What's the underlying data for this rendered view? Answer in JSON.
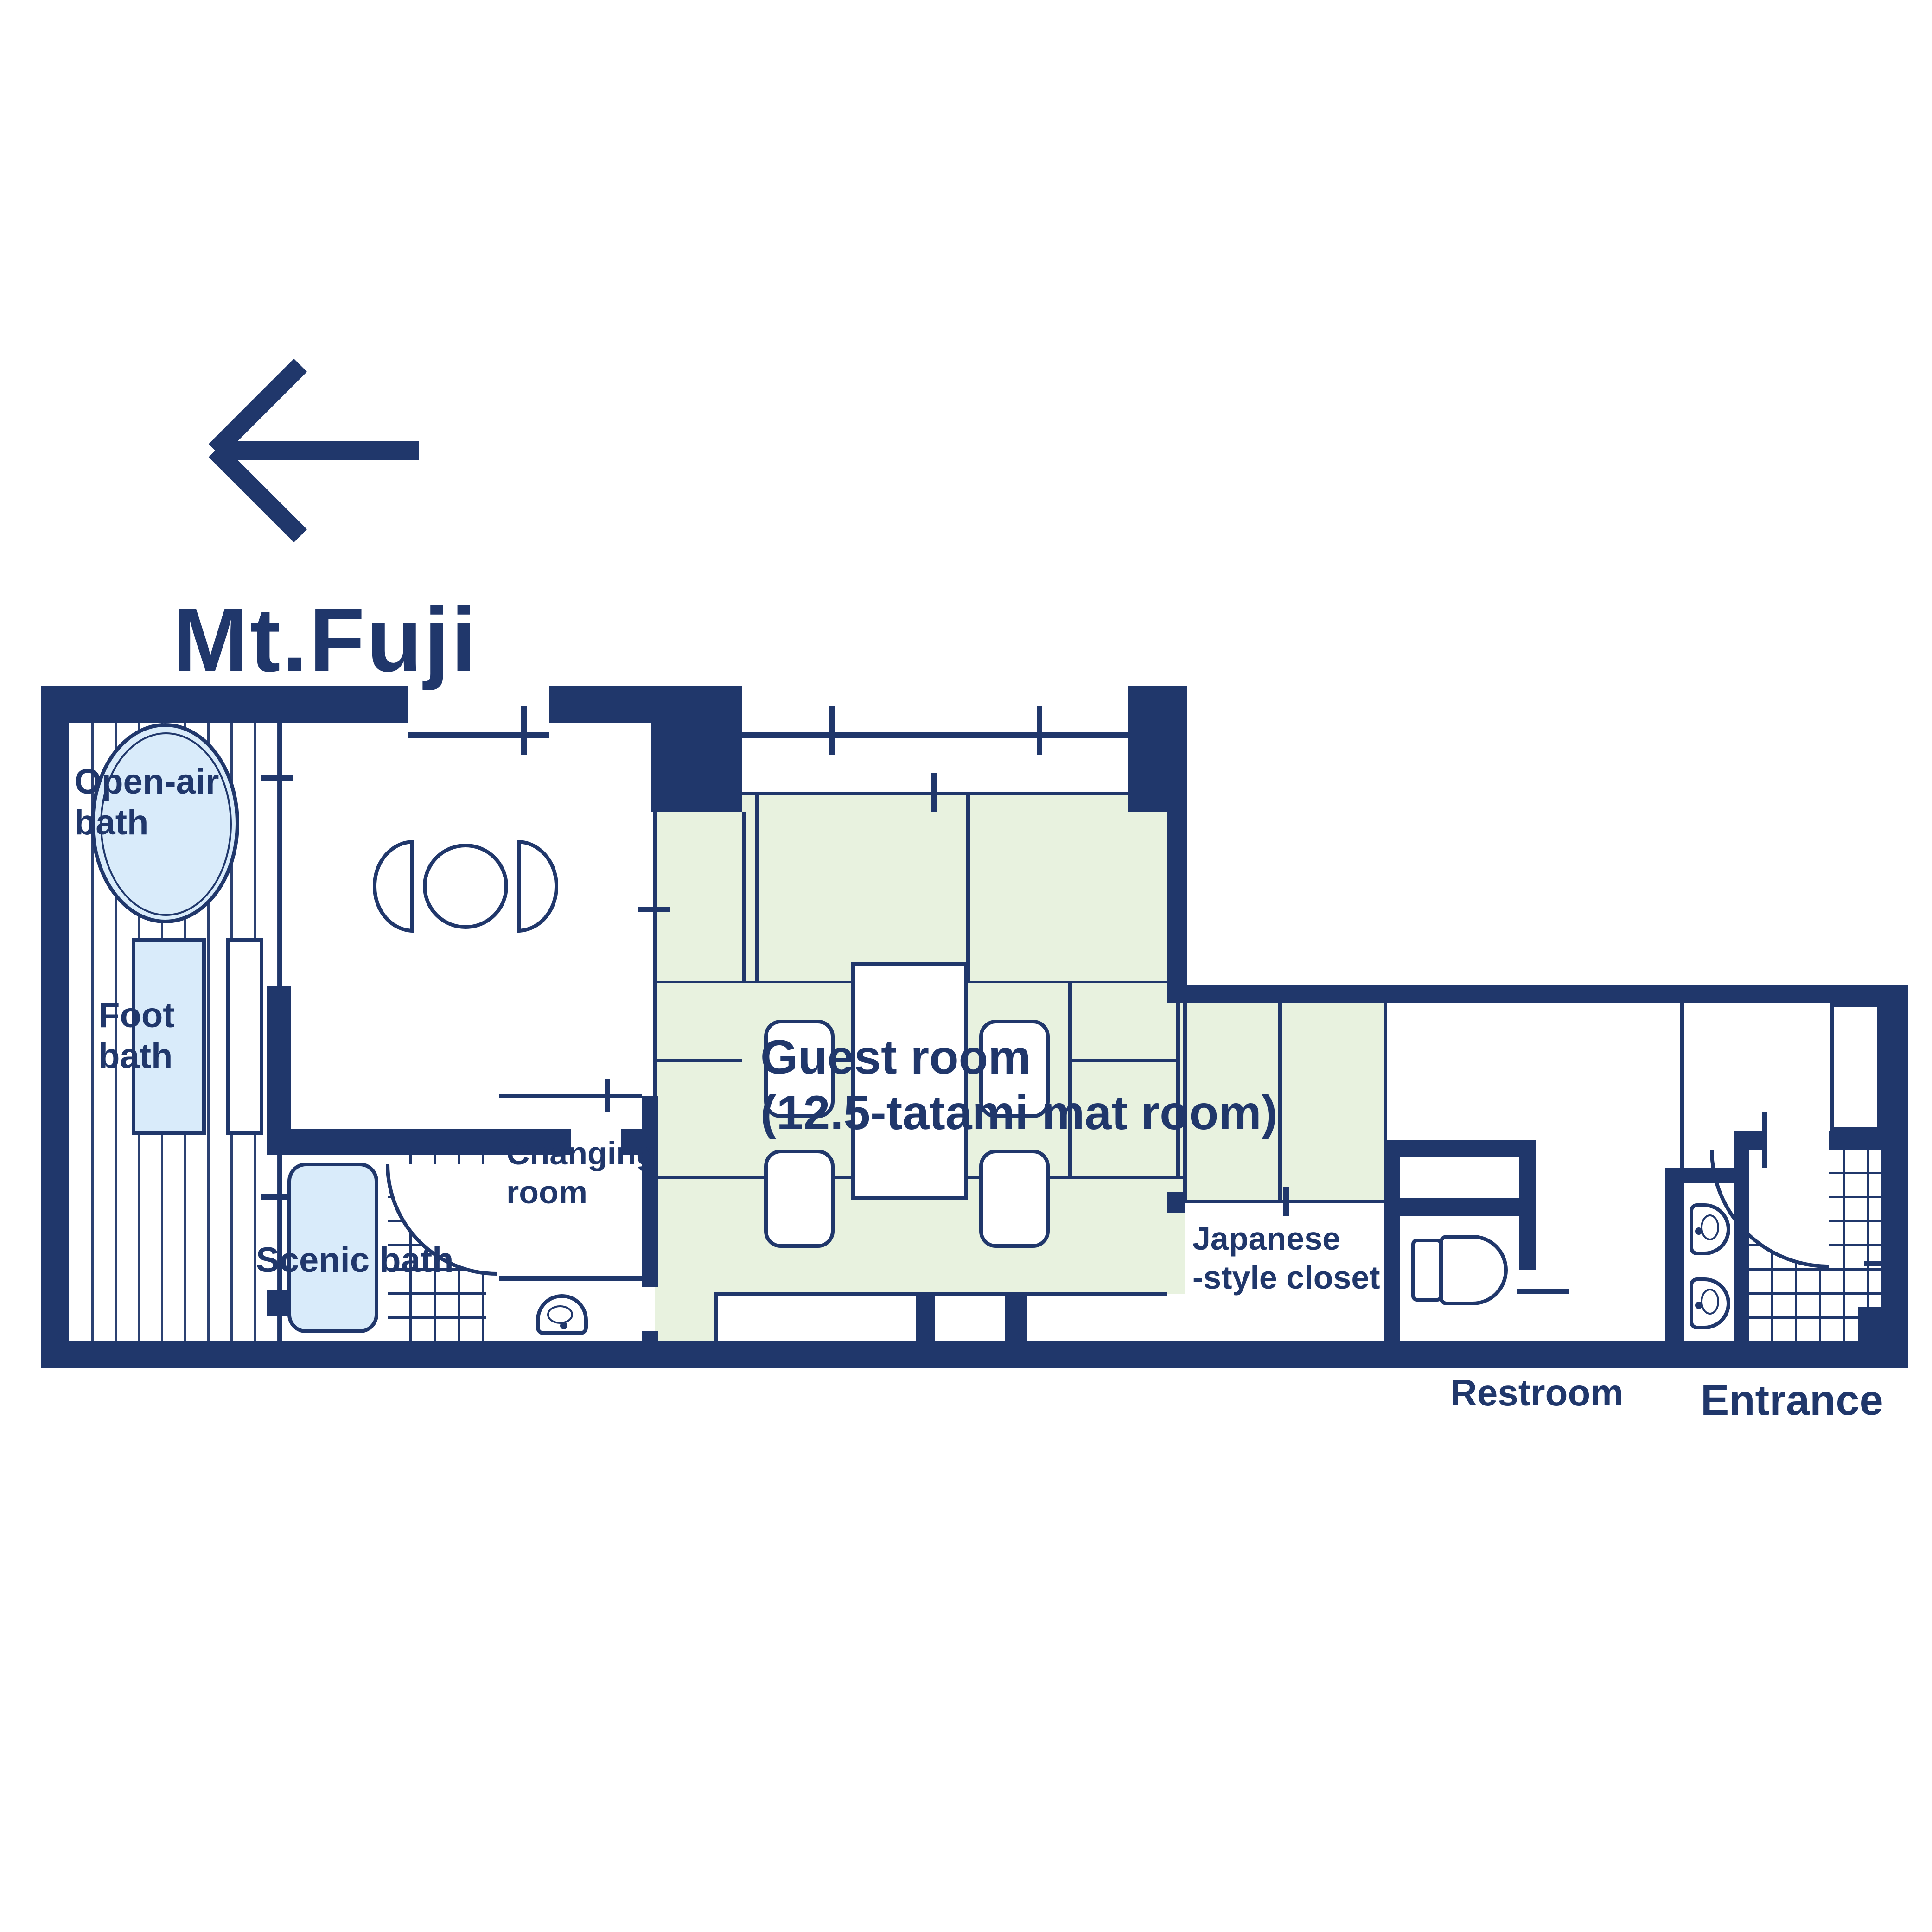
{
  "direction": {
    "label": "Mt.Fuji"
  },
  "rooms": {
    "open_air_bath": {
      "line1": "Open-air",
      "line2": "bath"
    },
    "foot_bath": {
      "line1": "Foot",
      "line2": "bath"
    },
    "scenic_bath": {
      "label": "Scenic bath"
    },
    "changing_room": {
      "line1": "Changing",
      "line2": "room"
    },
    "guest_room": {
      "line1": "Guest room",
      "line2": "(12.5-tatami mat room)"
    },
    "closet": {
      "line1": "Japanese",
      "line2": "-style closet"
    },
    "restroom": {
      "label": "Restroom"
    },
    "entrance": {
      "label": "Entrance"
    }
  },
  "colors": {
    "wall_navy": "#20376b",
    "tatami_green": "#e8f2df",
    "bath_blue": "#d9ebfa",
    "background": "#ffffff"
  }
}
